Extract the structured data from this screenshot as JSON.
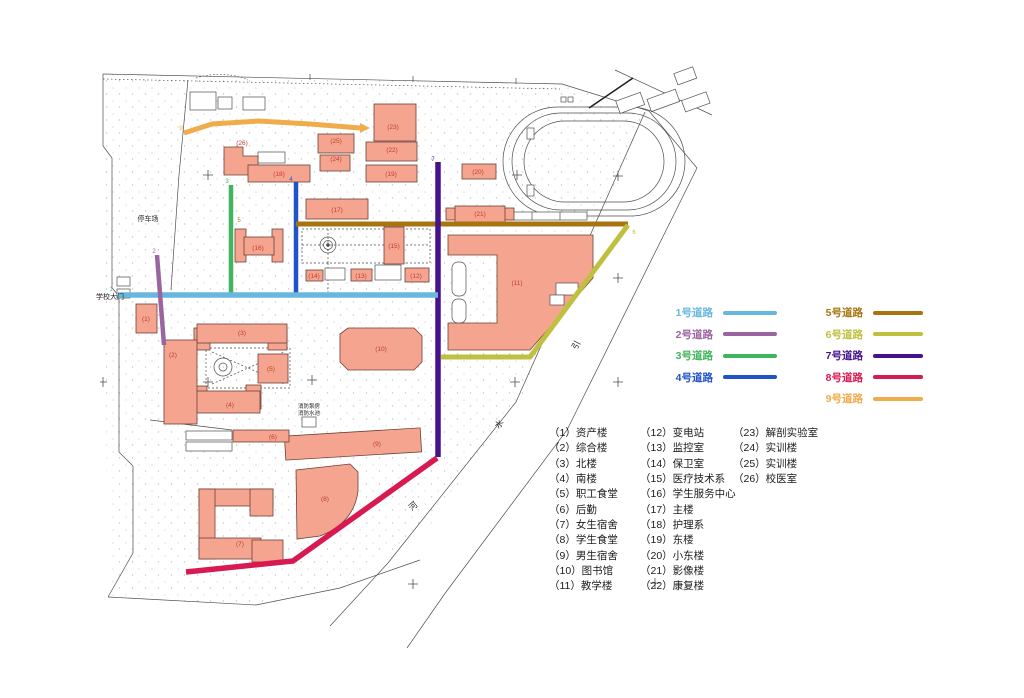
{
  "colors": {
    "building_fill": "#F5A58F",
    "building_stroke": "#6B4038",
    "building_label": "#C23B2E",
    "map_line": "#4F4F4F",
    "list_text": "#1B1B1B"
  },
  "roads": [
    {
      "num": "1",
      "name": "1号道路",
      "color": "#68B7DE"
    },
    {
      "num": "2",
      "name": "2号道路",
      "color": "#9A64A0"
    },
    {
      "num": "3",
      "name": "3号道路",
      "color": "#41B45E"
    },
    {
      "num": "4",
      "name": "4号道路",
      "color": "#2153C8"
    },
    {
      "num": "5",
      "name": "5号道路",
      "color": "#A87410"
    },
    {
      "num": "6",
      "name": "6号道路",
      "color": "#C0C040"
    },
    {
      "num": "7",
      "name": "7号道路",
      "color": "#45128C"
    },
    {
      "num": "8",
      "name": "8号道路",
      "color": "#D81A52"
    },
    {
      "num": "9",
      "name": "9号道路",
      "color": "#F0AC4A"
    }
  ],
  "map": {
    "region_labels": {
      "parking": "停车场",
      "gate": "学校大门",
      "fire_pump_room": "消防泵房",
      "fire_pool": "消防水池"
    },
    "river_name_chars": [
      "引",
      "水",
      "河"
    ],
    "building_labels": [
      "(1)",
      "(2)",
      "(3)",
      "(4)",
      "(5)",
      "(6)",
      "(7)",
      "(8)",
      "(9)",
      "(10)",
      "(11)",
      "(12)",
      "(13)",
      "(14)",
      "(15)",
      "(16)",
      "(17)",
      "(18)",
      "(19)",
      "(20)",
      "(21)",
      "(22)",
      "(23)",
      "(24)",
      "(25)",
      "(26)"
    ]
  },
  "legend": {
    "building_list": {
      "col1": [
        "（1）资产楼",
        "（2）综合楼",
        "（3）北楼",
        "（4）南楼",
        "（5）职工食堂",
        "（6）后勤",
        "（7）女生宿舍",
        "（8）学生食堂",
        "（9）男生宿舍",
        "（10）图书馆",
        "（11）教学楼"
      ],
      "col2": [
        "（12）变电站",
        "（13）监控室",
        "（14）保卫室",
        "（15）医疗技术系",
        "（16）学生服务中心",
        "（17）主楼",
        "（18）护理系",
        "（19）东楼",
        "（20）小东楼",
        "（21）影像楼",
        "（22）康复楼"
      ],
      "col3": [
        "（23）解剖实验室",
        "（24）实训楼",
        "（25）实训楼",
        "（26）校医室"
      ]
    }
  }
}
